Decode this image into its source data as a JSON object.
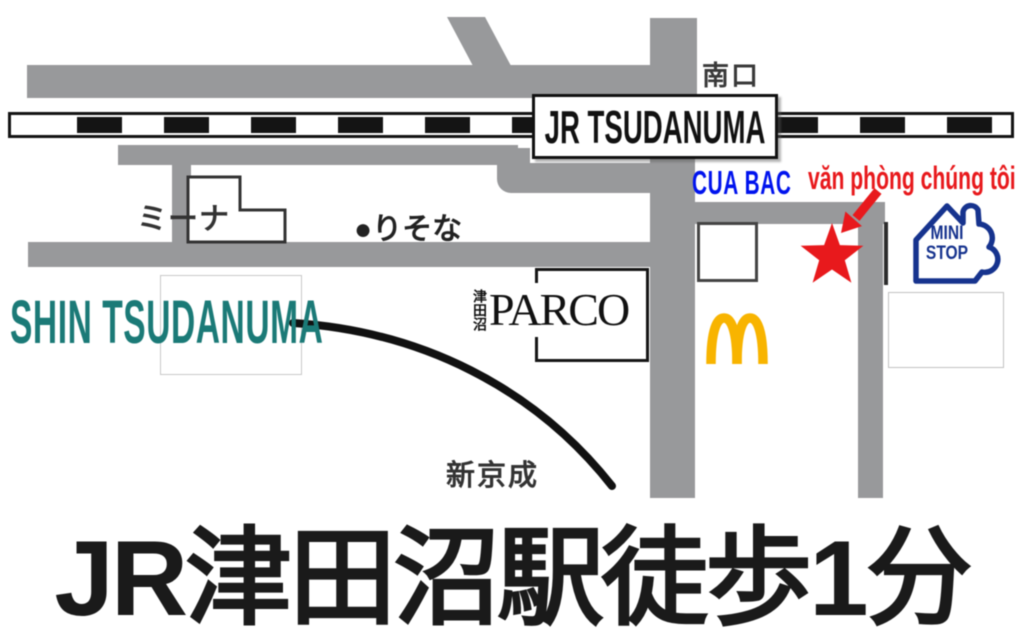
{
  "map": {
    "station_box": "JR TSUDANUMA",
    "south_exit": "南口",
    "north_gate": "CUA BAC",
    "office_note": "văn phòng chúng tôi",
    "headline": "JR津田沼駅徒歩1分",
    "landmarks": {
      "mina": "ミーナ",
      "risona": "●りそな",
      "parco_city": "津田沼",
      "parco": "PARCO",
      "shin_tsudanuma": "SHIN TSUDANUMA",
      "shinkeisei": "新京成",
      "ministop_line1": "MINI",
      "ministop_line2": "STOP"
    },
    "colors": {
      "road": "#98999b",
      "rail": "#141414",
      "teal": "#1b7a77",
      "blue": "#0013ee",
      "red": "#e8191c",
      "gold": "#f8b400",
      "navy": "#16338e"
    }
  }
}
